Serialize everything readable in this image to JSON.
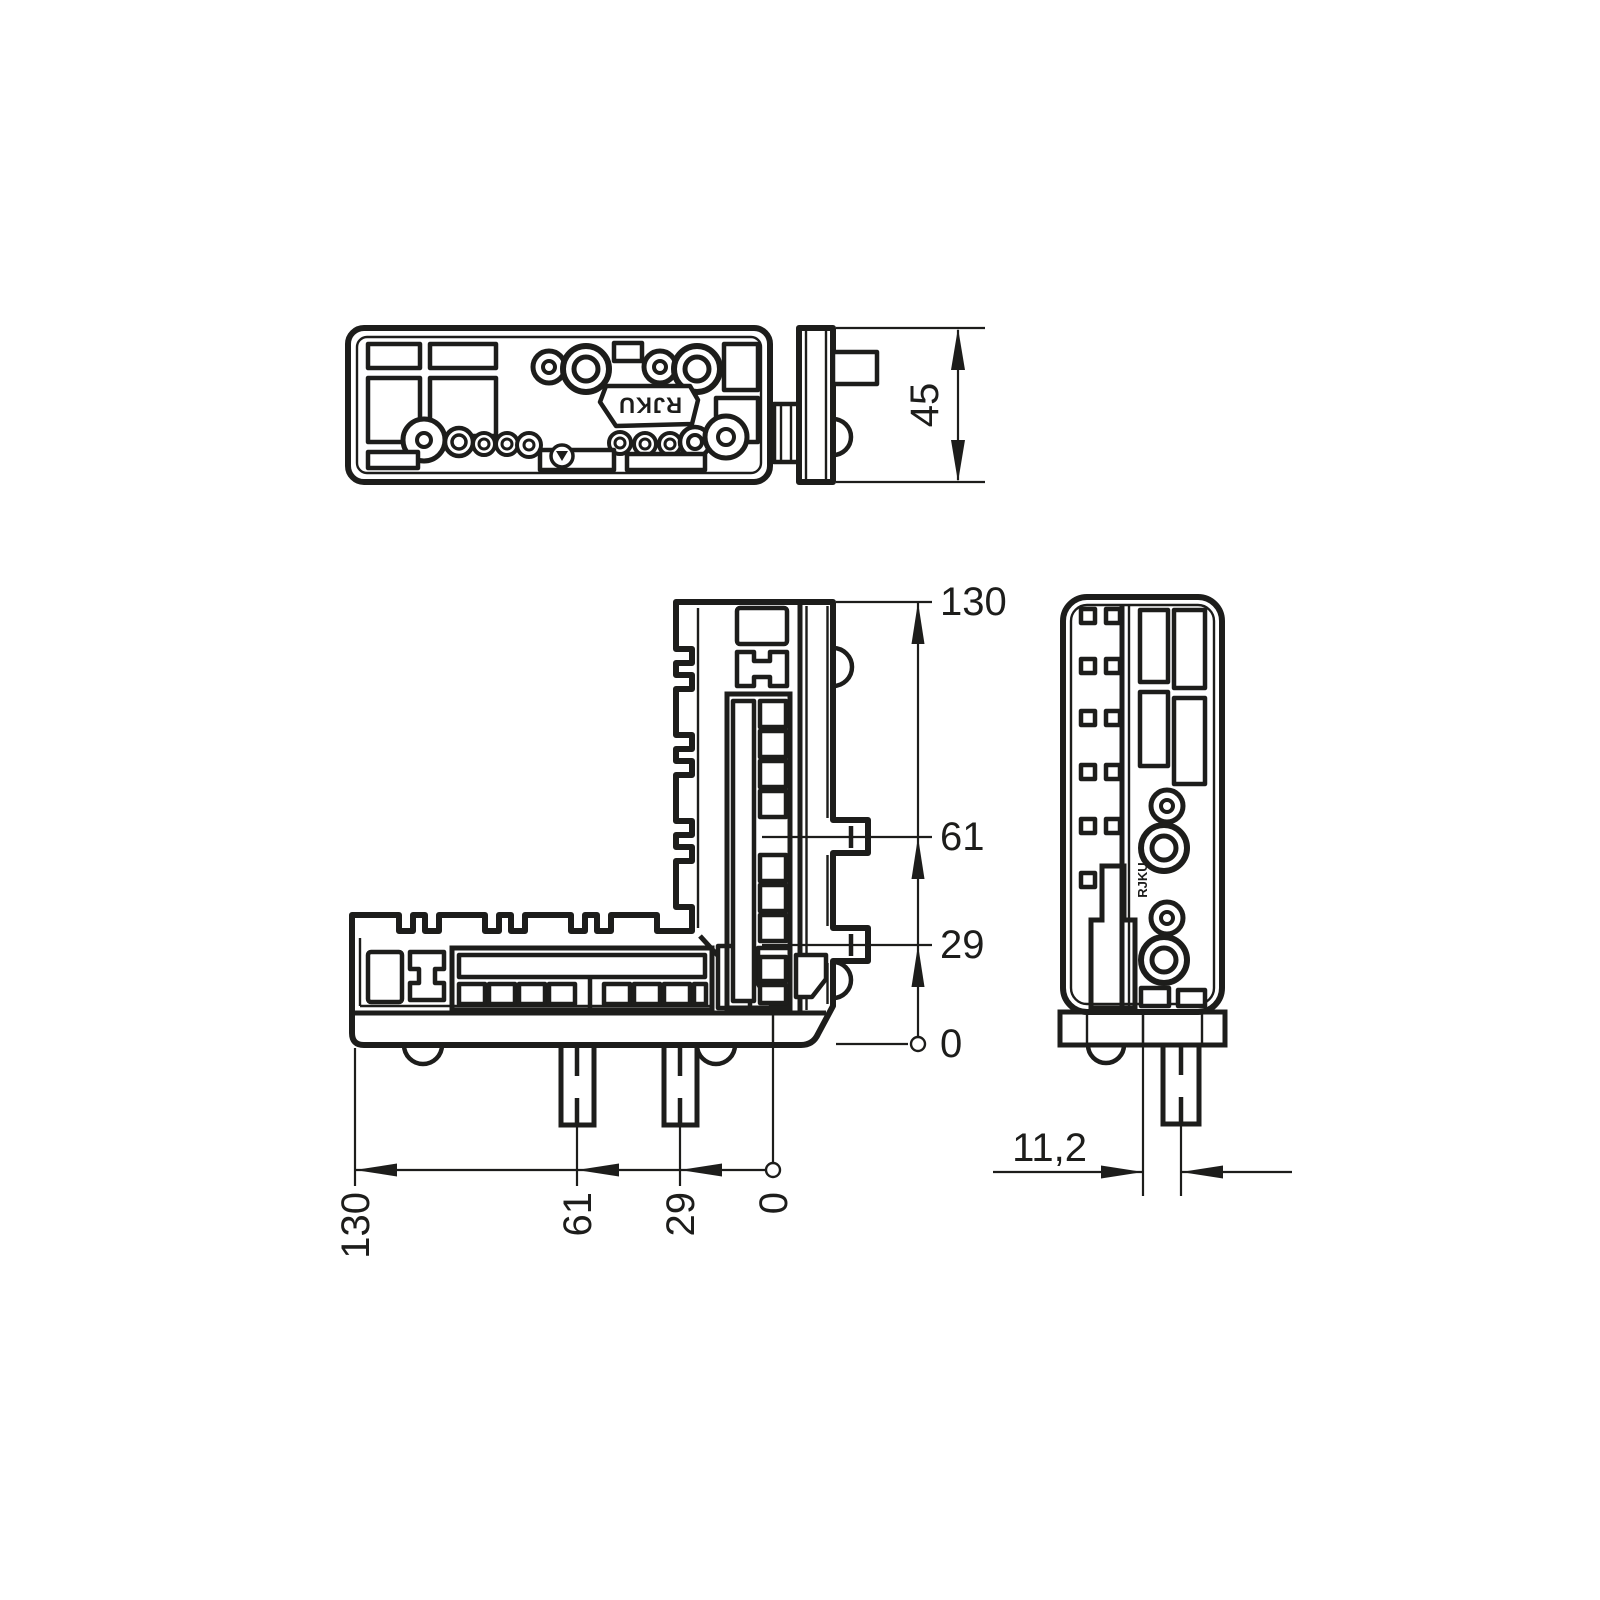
{
  "drawing": {
    "brand": "RJKU",
    "brand_small": "RJKU",
    "dims": {
      "plate_height": "45",
      "pin_offset": "11,2",
      "vertical": [
        "130",
        "61",
        "29",
        "0"
      ],
      "horizontal": [
        "130",
        "61",
        "29",
        "0"
      ]
    },
    "icons": {
      "recycle": "recycling-mark-icon"
    }
  }
}
